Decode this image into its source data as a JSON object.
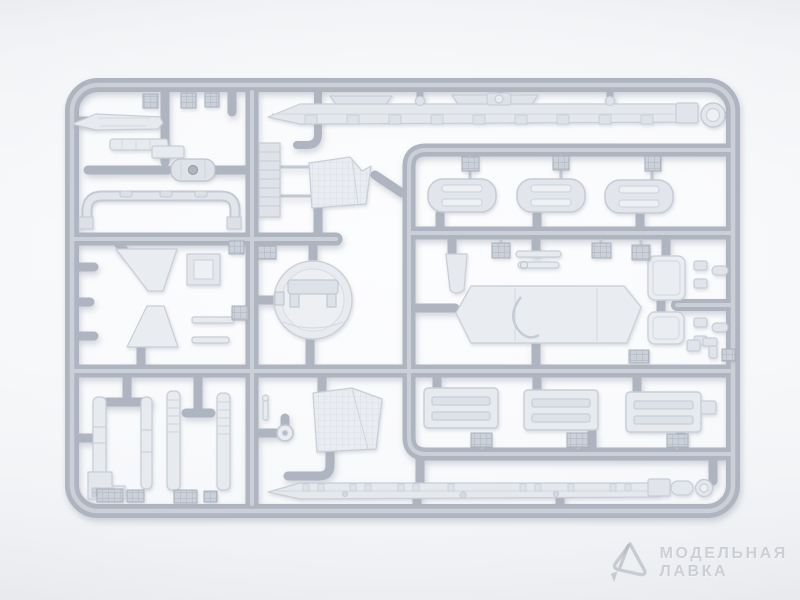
{
  "scene": {
    "description": "Photograph of a light gray injection-molded plastic model kit sprue (parts frame) with many unpainted parts, shot on a white seamless background",
    "background_color": "#f2f4f6",
    "sprue_color": "#aeb5c0",
    "parts_color": "#e6e9ee",
    "watermark_color": "#c4c9d0"
  },
  "watermark": {
    "logo_icon": "crystal-icon",
    "brand_line1": "МОДЕЛЬНАЯ",
    "brand_line2": "ЛАВКА"
  }
}
